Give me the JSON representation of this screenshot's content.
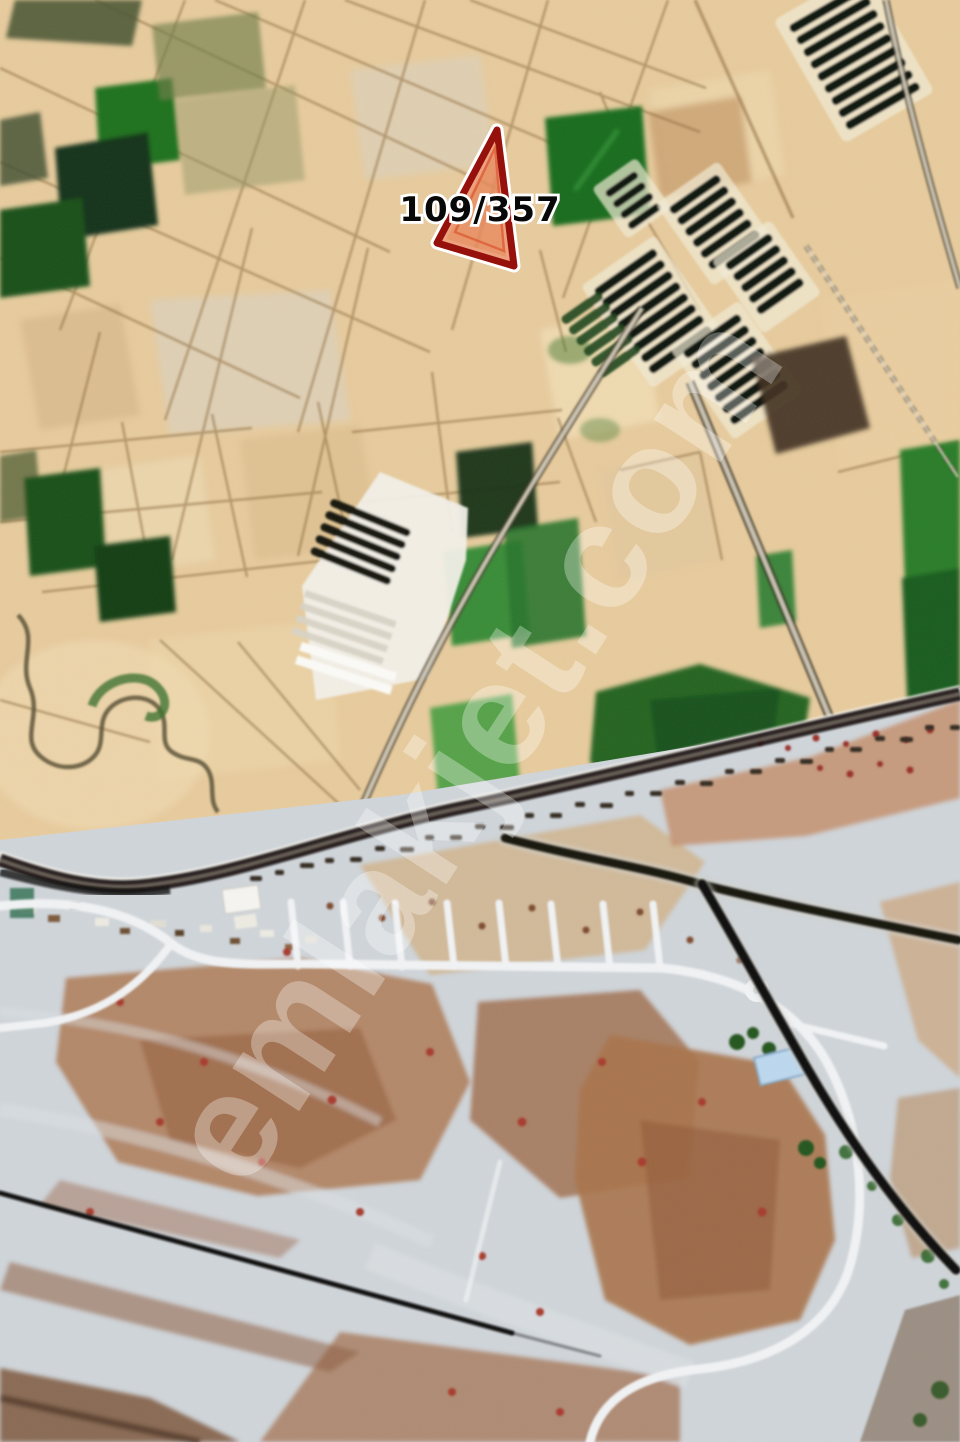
{
  "map": {
    "kind": "satellite-aerial-photo",
    "marker": {
      "label": "109/357",
      "shape": "triangle",
      "border_color": "#8e1511",
      "fill_color": "#e08a63",
      "halo_color": "#ffffff",
      "label_color": "#0a0a0a",
      "label_outline_color": "#ffffff"
    },
    "watermark": {
      "text": "emlakjet.com",
      "color": "#ffffff",
      "opacity": 0.3,
      "angle_deg": -57
    },
    "palette": {
      "farmland_light": "#e6cda4",
      "farmland_mid": "#d9bf97",
      "crop_dark_green": "#1d5a22",
      "crop_green": "#3c8a3c",
      "orchard_bar": "#0c120c",
      "boundary_line": "#8a6b42",
      "road_asphalt": "#12100c",
      "road_dirt_light": "#d8d2c2",
      "development_ground": "#cfd4d9",
      "bare_soil_brown": "#a4744f",
      "white_road": "#f0f2f4"
    },
    "layers": [
      {
        "name": "farm-parcels"
      },
      {
        "name": "orchard-rows"
      },
      {
        "name": "greenhouses"
      },
      {
        "name": "creek"
      },
      {
        "name": "roads"
      },
      {
        "name": "development-area"
      },
      {
        "name": "parcel-marker"
      },
      {
        "name": "watermark"
      }
    ]
  }
}
